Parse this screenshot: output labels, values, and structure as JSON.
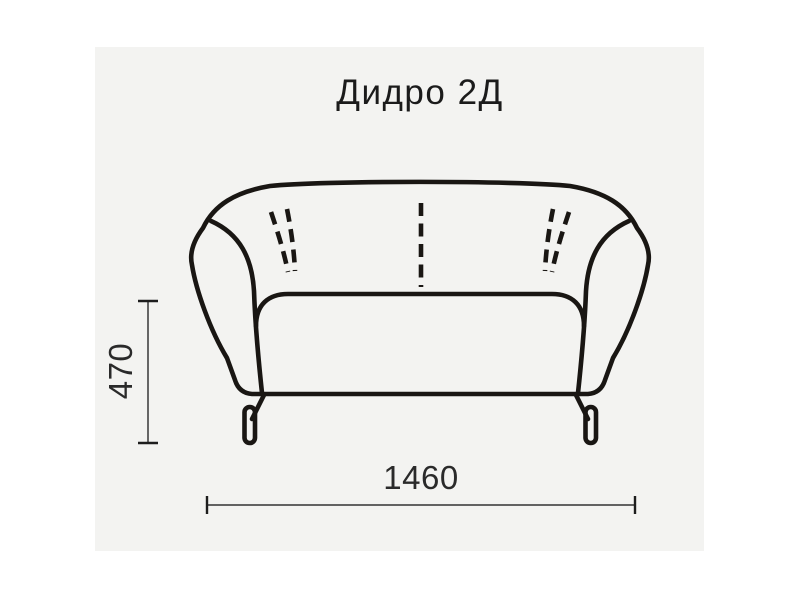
{
  "title": "Дидро 2Д",
  "dimensions": {
    "height": "470",
    "width": "1460"
  },
  "drawing": {
    "subject": "two-seat sofa front view line drawing",
    "features": [
      "curved backrest",
      "flared armrests",
      "seat cushion",
      "two metal legs with pill-shaped feet",
      "dashed stitch seams: left pair, center, right pair"
    ]
  },
  "colors": {
    "page_background": "#ffffff",
    "panel_background": "#f3f3f1",
    "line": "#191613",
    "dimension_line": "#4d4d4d",
    "dimension_tick": "#1d1d1d",
    "text": "#1b1b1b"
  }
}
